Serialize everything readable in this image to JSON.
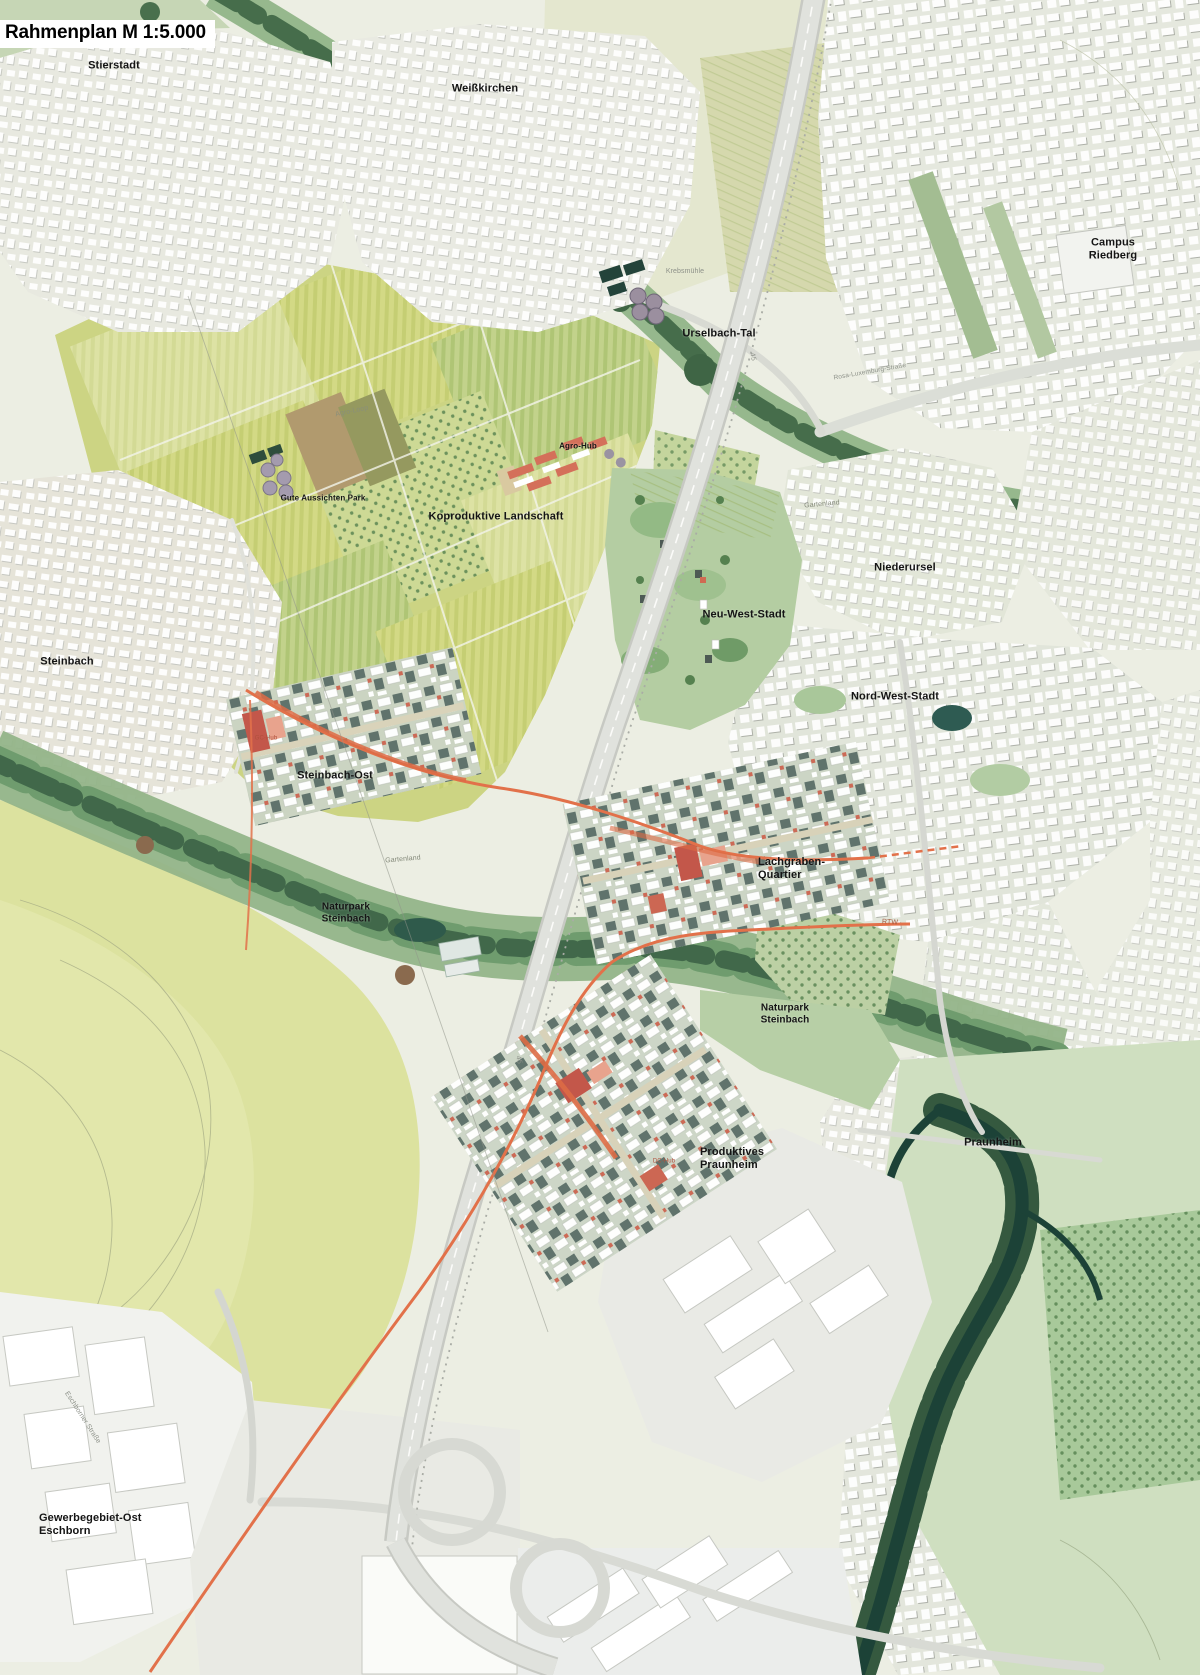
{
  "title": "Rahmenplan M 1:5.000",
  "map": {
    "place_labels": [
      {
        "id": "stierstadt",
        "text": "Stierstadt",
        "x": 114,
        "y": 66,
        "size": 11
      },
      {
        "id": "weisskirchen",
        "text": "Weißkirchen",
        "x": 485,
        "y": 89,
        "size": 11
      },
      {
        "id": "campus-riedberg",
        "text": "Campus Riedberg",
        "x": 1113,
        "y": 249,
        "size": 11
      },
      {
        "id": "urselbach-tal",
        "text": "Urselbach-Tal",
        "x": 719,
        "y": 334,
        "size": 11
      },
      {
        "id": "gute-aussichten-park",
        "text": "Gute Aussichten Park",
        "x": 323,
        "y": 498,
        "size": 8
      },
      {
        "id": "agro-hub",
        "text": "Agro-Hub",
        "x": 578,
        "y": 446,
        "size": 8
      },
      {
        "id": "koproduktive-landschaft",
        "text": "Koproduktive Landschaft",
        "x": 496,
        "y": 517,
        "size": 11
      },
      {
        "id": "niederursel",
        "text": "Niederursel",
        "x": 905,
        "y": 568,
        "size": 11
      },
      {
        "id": "neu-west-stadt",
        "text": "Neu-West-Stadt",
        "x": 744,
        "y": 615,
        "size": 11
      },
      {
        "id": "nord-west-stadt",
        "text": "Nord-West-Stadt",
        "x": 895,
        "y": 697,
        "size": 11
      },
      {
        "id": "steinbach",
        "text": "Steinbach",
        "x": 67,
        "y": 662,
        "size": 11
      },
      {
        "id": "steinbach-ost",
        "text": "Steinbach-Ost",
        "x": 335,
        "y": 776,
        "size": 11
      },
      {
        "id": "lachgraben-quartier",
        "lines": [
          "Lachgraben-",
          "Quartier"
        ],
        "x": 758,
        "y": 856,
        "size": 11,
        "align": "left"
      },
      {
        "id": "naturpark-steinbach-west",
        "lines": [
          "Naturpark",
          "Steinbach"
        ],
        "x": 346,
        "y": 913,
        "size": 10
      },
      {
        "id": "naturpark-steinbach-ost",
        "lines": [
          "Naturpark",
          "Steinbach"
        ],
        "x": 785,
        "y": 1014,
        "size": 10
      },
      {
        "id": "produktives-praunheim",
        "lines": [
          "Produktives",
          "Praunheim"
        ],
        "x": 700,
        "y": 1146,
        "size": 11,
        "align": "left"
      },
      {
        "id": "praunheim",
        "text": "Praunheim",
        "x": 993,
        "y": 1143,
        "size": 11
      },
      {
        "id": "gewerbegebiet-ost-eschborn",
        "lines": [
          "Gewerbegebiet-Ost",
          "Eschborn"
        ],
        "x": 39,
        "y": 1512,
        "size": 11,
        "align": "left"
      }
    ],
    "minor_labels": [
      {
        "id": "krebsmuehle",
        "text": "Krebsmühle",
        "x": 685,
        "y": 272,
        "size": 7,
        "color": "#8d9189"
      },
      {
        "id": "agro-loop",
        "text": "Agro-Loop",
        "x": 352,
        "y": 412,
        "size": 7,
        "color": "#8a8f7a",
        "rotate": -12
      },
      {
        "id": "gartenland-nord",
        "text": "Gartenland",
        "x": 822,
        "y": 505,
        "size": 7,
        "color": "#84897a",
        "rotate": -5
      },
      {
        "id": "gartenland-sued",
        "text": "Gartenland",
        "x": 403,
        "y": 860,
        "size": 7,
        "color": "#84897a",
        "rotate": -5
      },
      {
        "id": "rtw",
        "text": "RTW",
        "x": 890,
        "y": 923,
        "size": 7,
        "color": "#a35a40",
        "rotate": 3
      },
      {
        "id": "rosa-luxemburg-strasse",
        "text": "Rosa-Luxemburg-Straße",
        "x": 870,
        "y": 372,
        "size": 6.5,
        "color": "#8d9189",
        "rotate": -10
      },
      {
        "id": "eschborner-strasse",
        "text": "Eschborner Straße",
        "x": 82,
        "y": 1418,
        "size": 7,
        "color": "#8d9189",
        "rotate": 57
      },
      {
        "id": "autobahn-45-nord",
        "text": "45",
        "x": 752,
        "y": 357,
        "size": 7,
        "color": "#8d9189",
        "rotate": 78
      },
      {
        "id": "autobahn-45-sued",
        "text": "45",
        "x": 518,
        "y": 1060,
        "size": 7,
        "color": "#8d9189",
        "rotate": 78
      },
      {
        "id": "gc-hub",
        "text": "GC-Hub",
        "x": 266,
        "y": 739,
        "size": 6,
        "color": "#b0503c"
      },
      {
        "id": "dc-hub",
        "text": "DC-Hub",
        "x": 664,
        "y": 1162,
        "size": 6,
        "color": "#b0503c"
      }
    ],
    "palette": {
      "field_yellow": "#d3d985",
      "field_green": "#c2d28b",
      "meadow": "#dce29f",
      "park_green": "#b4cda2",
      "forest_dark": "#466d4b",
      "water_dark": "#1c4237",
      "urban_light": "#e8e9e0",
      "new_quarter_base": "#ccd5c5",
      "new_quarter_block": "#5d7069",
      "accent_building_red": "#c3574a",
      "route_orange": "#e2714a",
      "road_gray": "#e0e2dd",
      "label_black": "#141414"
    }
  }
}
